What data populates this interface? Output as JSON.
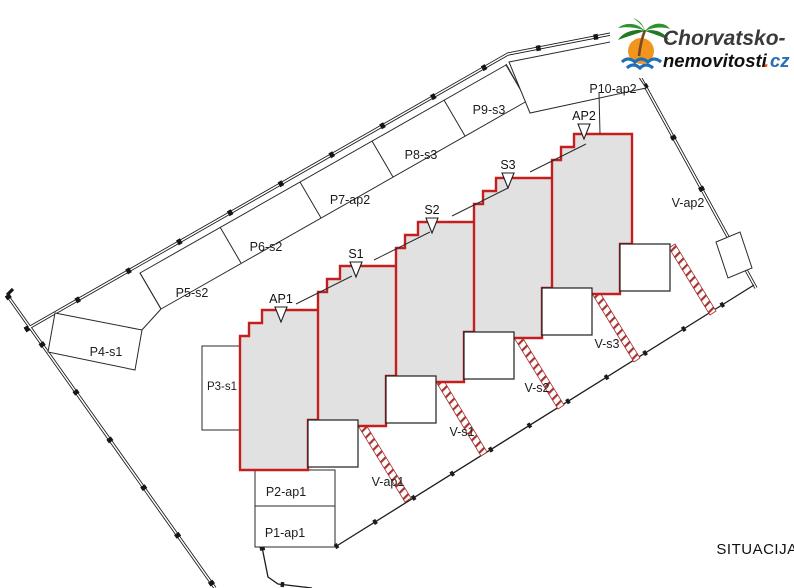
{
  "header": {
    "logo": {
      "brand_line1": "Chorvatsko-",
      "brand_line2_name": "nemovitosti",
      "brand_line2_dot": ".",
      "brand_line2_tld": "cz"
    }
  },
  "plan": {
    "title": "SITUACIJA",
    "parking_row": [
      "P5-s2",
      "P6-s2",
      "P7-ap2",
      "P8-s3",
      "P9-s3",
      "P10-ap2"
    ],
    "parking_bottom": [
      "P1-ap1",
      "P2-ap1"
    ],
    "parking_side": "P3-s1",
    "parking_west": "P4-s1",
    "unit_markers": [
      "AP1",
      "S1",
      "S2",
      "S3",
      "AP2"
    ],
    "gardens": [
      "V-ap1",
      "V-s1",
      "V-s2",
      "V-s3",
      "V-ap2"
    ]
  },
  "colors": {
    "unit_outline": "#c41e1e",
    "unit_fill": "#e1e1e1",
    "fence_hatch": "#a83232",
    "boundary": "#161616",
    "logo_green": "#2f9230",
    "logo_orange": "#f2951f",
    "logo_wave_blue": "#1e6fb8",
    "logo_dot": "#e8580e",
    "logo_tld_blue": "#2a6db5",
    "logo_text": "#3a3a3a"
  }
}
